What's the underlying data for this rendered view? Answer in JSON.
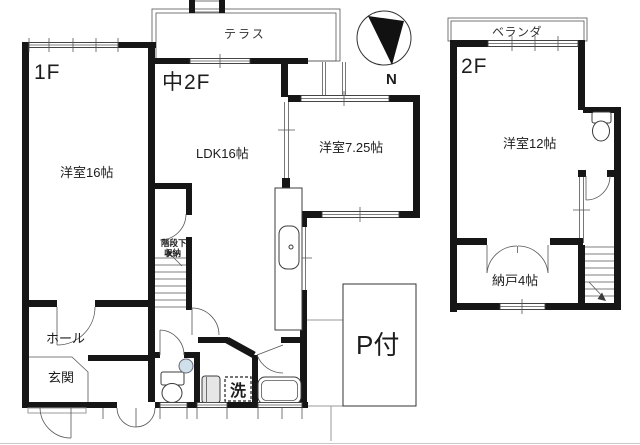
{
  "title": "floor-plan",
  "colors": {
    "wall": "#161616",
    "thin_line": "#3c3c3c",
    "gray_line": "#9a9a9a",
    "basin_fill": "#cfe0eb",
    "fixture_gray": "#e6e6e6",
    "background": "#ffffff"
  },
  "floors": {
    "f1": {
      "label": "1F"
    },
    "mid2f": {
      "label": "中2F"
    },
    "f2": {
      "label": "2F"
    }
  },
  "rooms": {
    "western16": "洋室16帖",
    "ldk": "LDK16帖",
    "western725": "洋室7.25帖",
    "western12": "洋室12帖",
    "storage4": "納戸4帖",
    "terrace": "テラス",
    "veranda": "ベランダ",
    "hall": "ホール",
    "entrance": "玄関",
    "under_stair_1": "階段下",
    "under_stair_2": "収納",
    "laundry": "洗",
    "parking": "P付"
  },
  "compass": {
    "label": "N"
  }
}
